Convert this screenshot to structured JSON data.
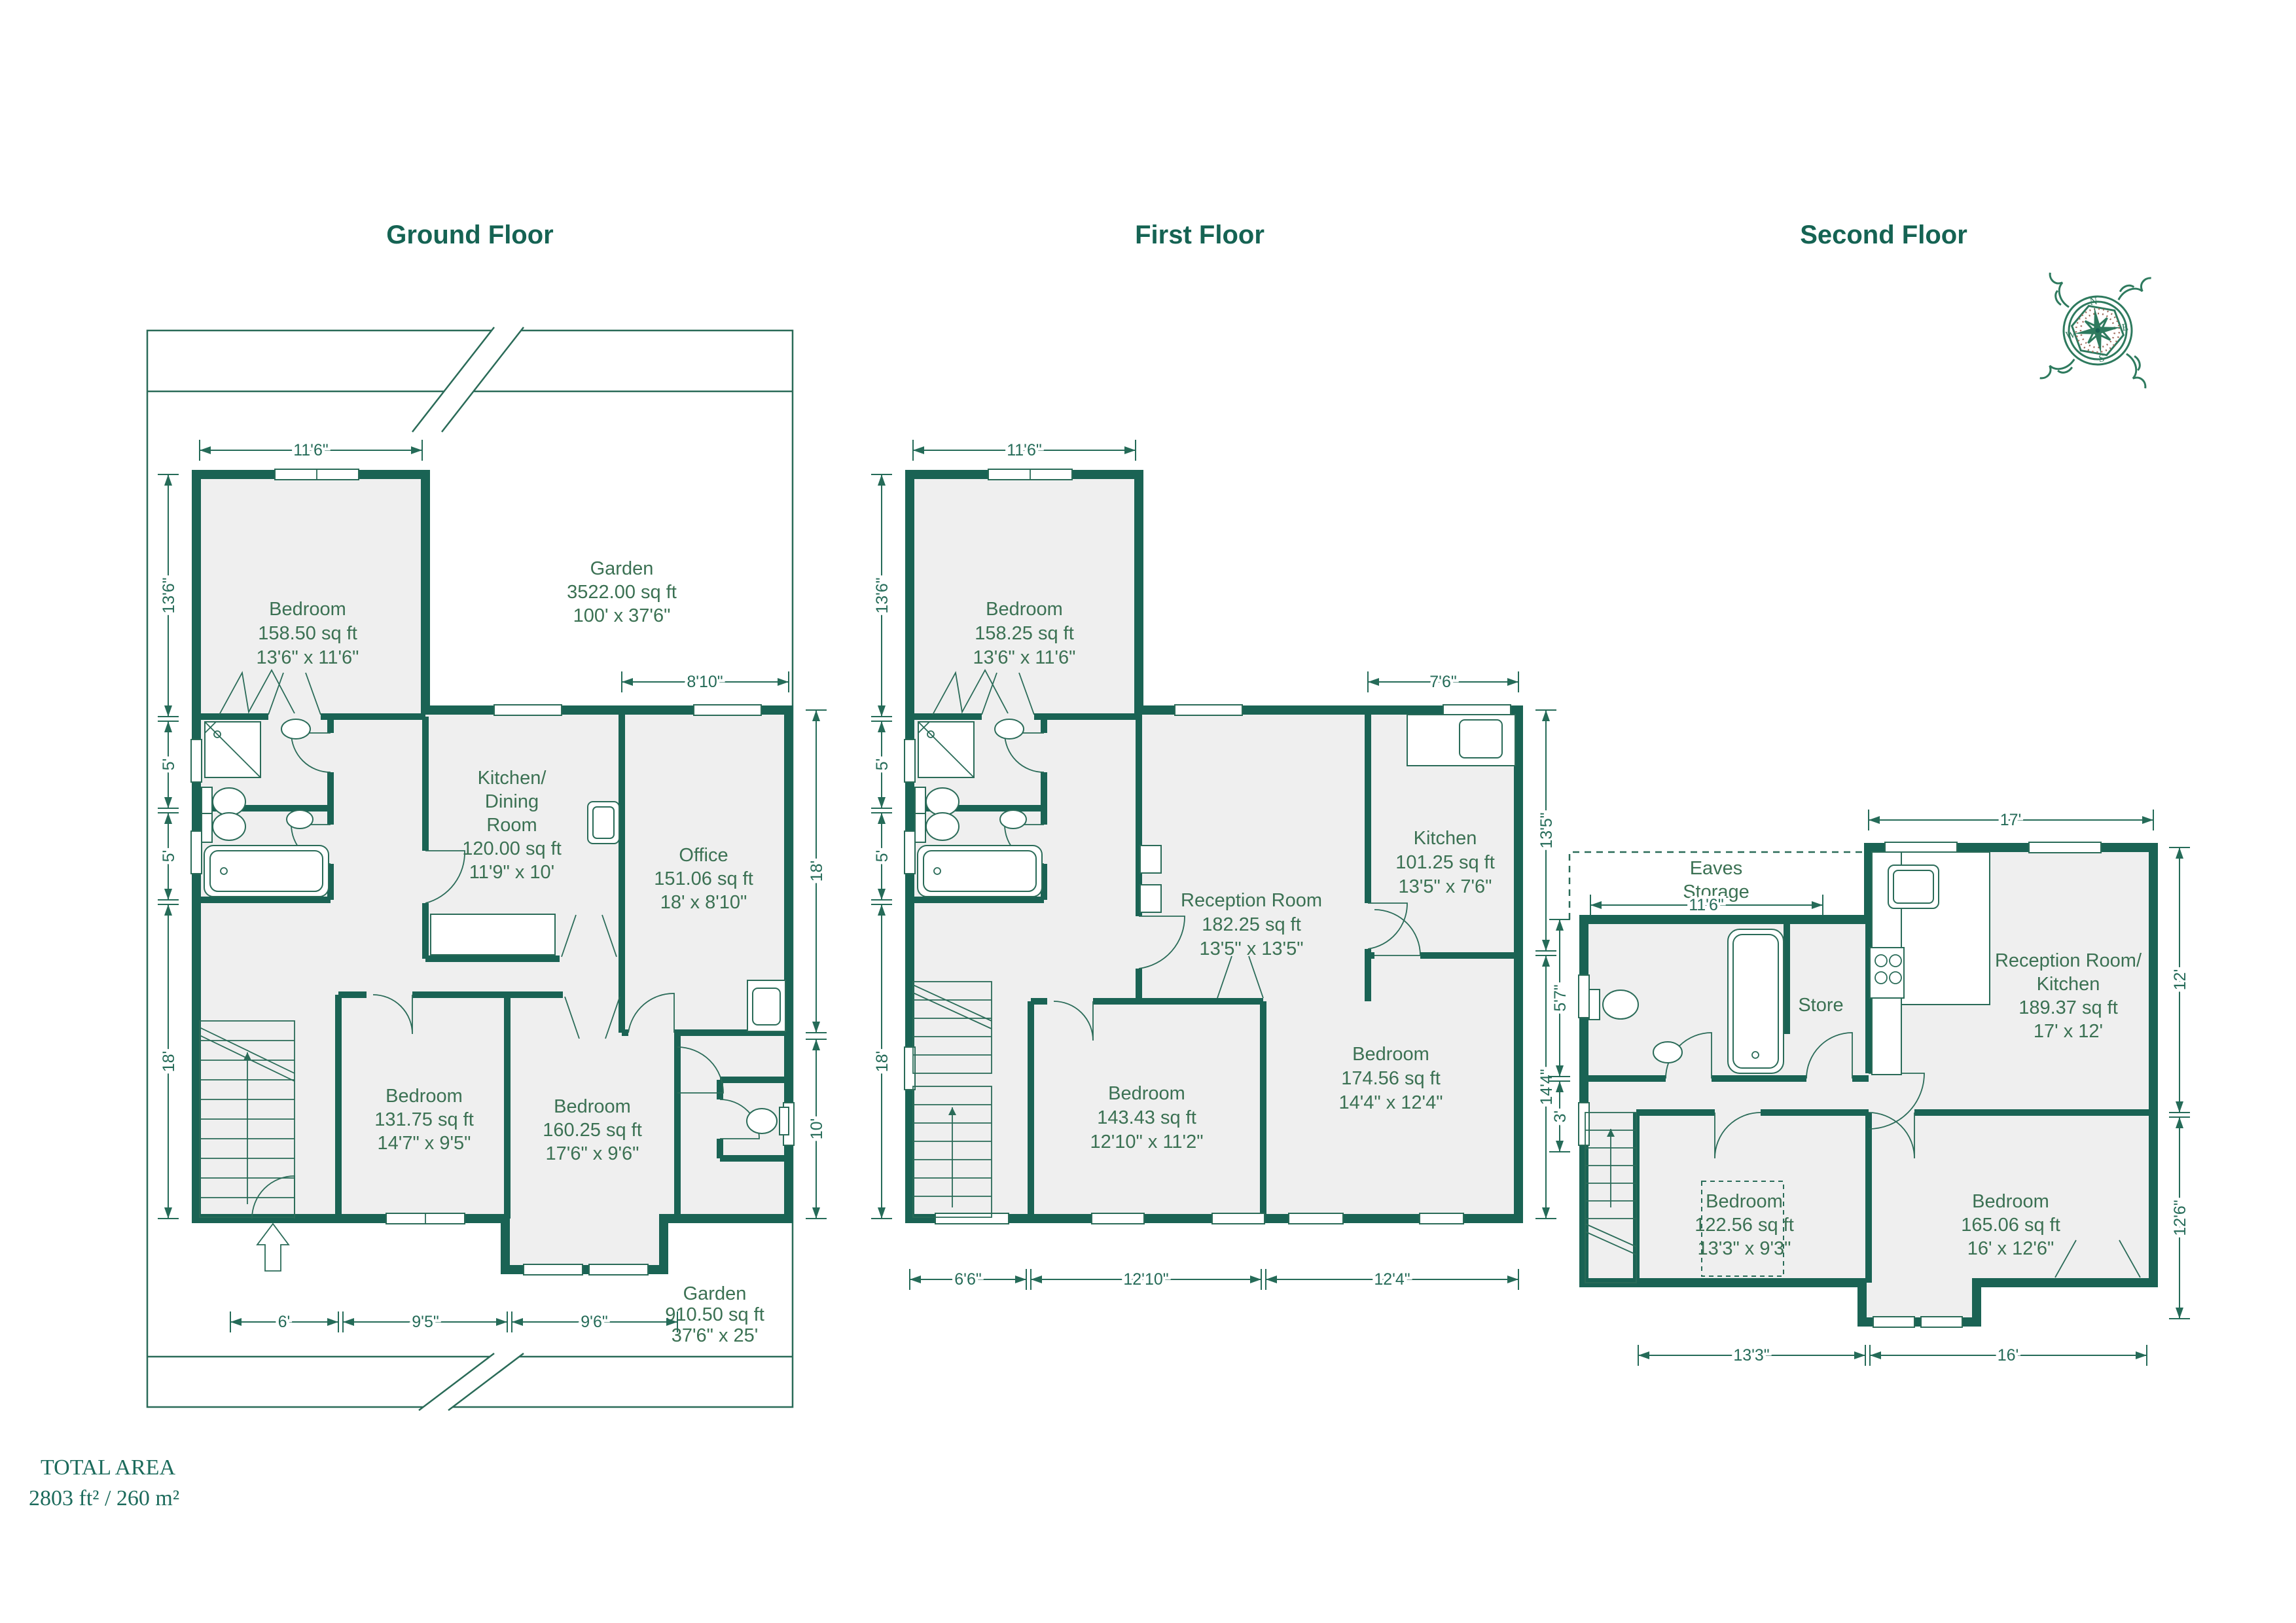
{
  "colors": {
    "wall": "#1A6354",
    "line": "#2A6B58",
    "room_fill": "#EFEFEF",
    "label": "#3B7153",
    "dim": "#256B58",
    "title": "#156353",
    "serif": "#1C6B5C"
  },
  "titles": {
    "ground": "Ground Floor",
    "first": "First Floor",
    "second": "Second Floor"
  },
  "total_area": {
    "line1": "TOTAL AREA",
    "line2": "2803 ft² / 260 m²"
  },
  "compass": {
    "n": "N",
    "e": "E",
    "s": "S",
    "w": "W"
  },
  "ground": {
    "garden_top": {
      "name": "Garden",
      "area": "3522.00 sq ft",
      "dims": "100' x 37'6\""
    },
    "bedroom1": {
      "name": "Bedroom",
      "area": "158.50 sq ft",
      "dims": "13'6\" x 11'6\""
    },
    "kitchen": {
      "l1": "Kitchen/",
      "l2": "Dining",
      "l3": "Room",
      "area": "120.00 sq ft",
      "dims": "11'9\" x 10'"
    },
    "office": {
      "name": "Office",
      "area": "151.06 sq ft",
      "dims": "18' x 8'10\""
    },
    "bedroom2": {
      "name": "Bedroom",
      "area": "131.75 sq ft",
      "dims": "14'7\" x 9'5\""
    },
    "bedroom3": {
      "name": "Bedroom",
      "area": "160.25 sq ft",
      "dims": "17'6\" x 9'6\""
    },
    "garden_bottom": {
      "name": "Garden",
      "area": "910.50 sq ft",
      "dims": "37'6\" x 25'"
    },
    "dims": {
      "top": "11'6\"",
      "office_top": "8'10\"",
      "left1": "13'6\"",
      "left2": "5'",
      "left3": "5'",
      "left4": "18'",
      "right1": "18'",
      "right2": "10'",
      "bottom1": "6'",
      "bottom2": "9'5\"",
      "bottom3": "9'6\""
    }
  },
  "first": {
    "bedroom1": {
      "name": "Bedroom",
      "area": "158.25 sq ft",
      "dims": "13'6\" x 11'6\""
    },
    "reception": {
      "name": "Reception Room",
      "area": "182.25 sq ft",
      "dims": "13'5\" x 13'5\""
    },
    "kitchen": {
      "name": "Kitchen",
      "area": "101.25 sq ft",
      "dims": "13'5\" x 7'6\""
    },
    "bedroom2": {
      "name": "Bedroom",
      "area": "143.43 sq ft",
      "dims": "12'10\" x 11'2\""
    },
    "bedroom3": {
      "name": "Bedroom",
      "area": "174.56 sq ft",
      "dims": "14'4\" x 12'4\""
    },
    "dims": {
      "top": "11'6\"",
      "kitchen_top": "7'6\"",
      "left1": "13'6\"",
      "left2": "5'",
      "left3": "5'",
      "left4": "18'",
      "right1": "13'5\"",
      "right2": "14'4\"",
      "bottom1": "6'6\"",
      "bottom2": "12'10\"",
      "bottom3": "12'4\""
    }
  },
  "second": {
    "eaves": {
      "l1": "Eaves",
      "l2": "Storage"
    },
    "store": {
      "name": "Store"
    },
    "reception": {
      "l1": "Reception Room/",
      "l2": "Kitchen",
      "area": "189.37 sq ft",
      "dims": "17' x 12'"
    },
    "bedroom1": {
      "name": "Bedroom",
      "area": "122.56 sq ft",
      "dims": "13'3\" x 9'3\""
    },
    "bedroom2": {
      "name": "Bedroom",
      "area": "165.06 sq ft",
      "dims": "16' x 12'6\""
    },
    "dims": {
      "top": "17'",
      "eaves": "11'6\"",
      "left1": "5'7\"",
      "left2": "3'",
      "right1": "12'",
      "right2": "12'6\"",
      "bottom1": "13'3\"",
      "bottom2": "16'"
    }
  }
}
